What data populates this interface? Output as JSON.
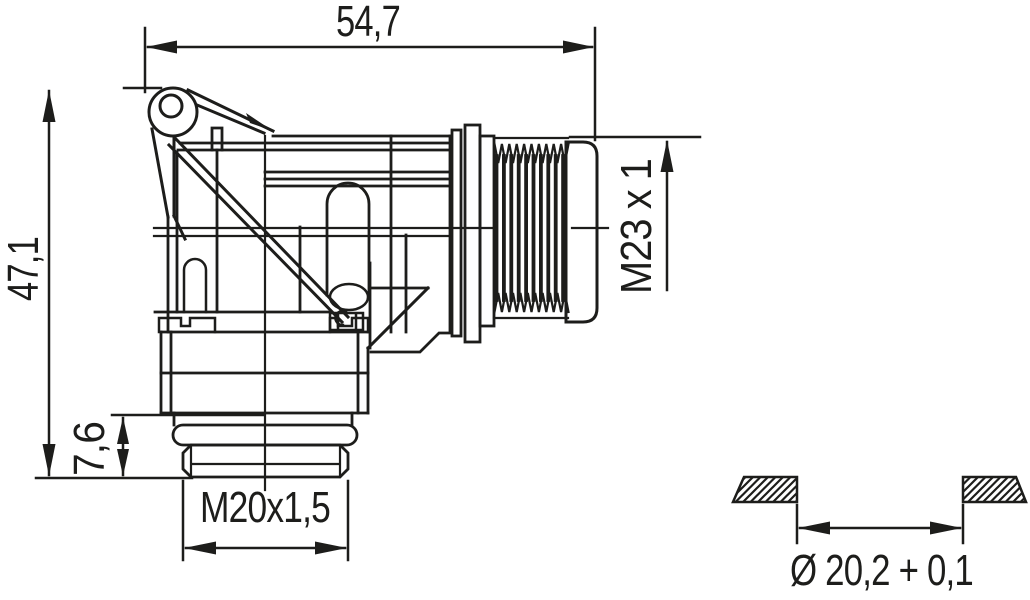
{
  "drawing": {
    "dimensions": {
      "overall_length": "54,7",
      "overall_height": "47,1",
      "flange_to_end_height": "7,6",
      "mating_thread": "M23 x 1",
      "cable_gland_thread": "M20x1,5",
      "gasket_bore": "Ø 20,2 + 0,1"
    },
    "colors": {
      "line": "#1d1d1b",
      "background": "#ffffff"
    }
  }
}
